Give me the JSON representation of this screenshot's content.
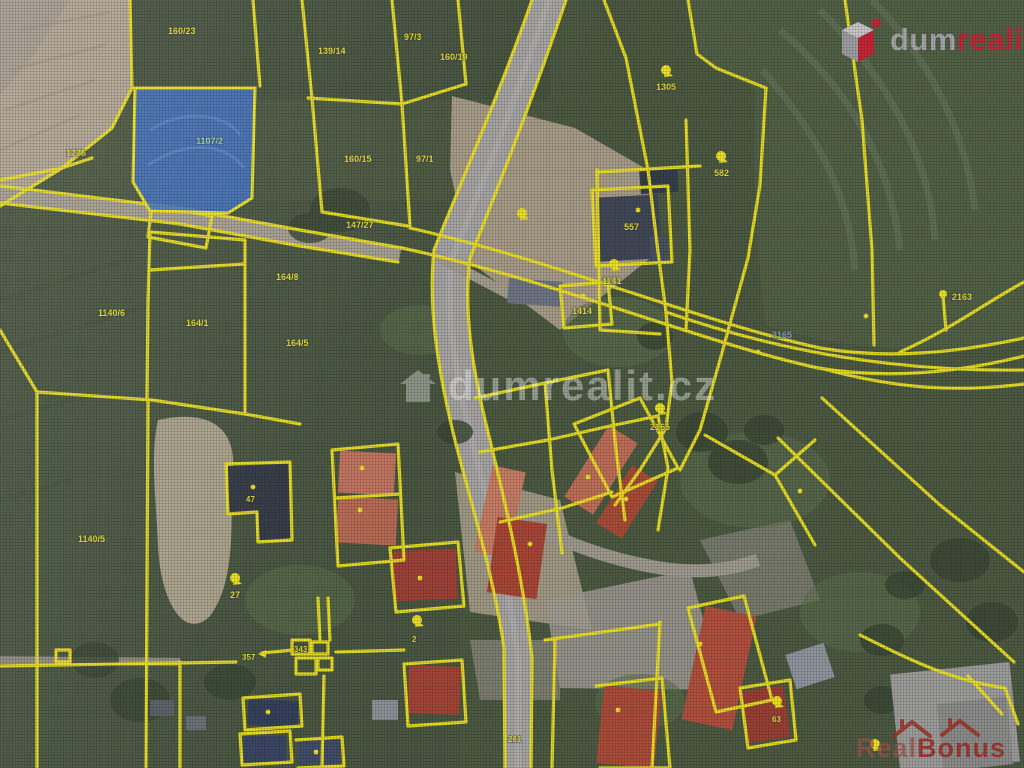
{
  "branding": {
    "logo": {
      "text_dum": "dum",
      "text_realit": "realit",
      "text_cz": ".cz",
      "red": "#c41e2f",
      "gray": "#a7a7ab"
    },
    "center_watermark": {
      "text": "dumrealit.cz"
    },
    "corner_watermark": {
      "text_real": "Real",
      "text_bonus": "Bonus",
      "color": "#9e261c"
    }
  },
  "map": {
    "type": "cadastral-satellite-view",
    "boundary_color": "#f0e41c",
    "highlighted_parcel": {
      "label": "1107/2",
      "fill": "#3f6fc0"
    },
    "parcel_labels": [
      {
        "text": "160/23"
      },
      {
        "text": "139/14"
      },
      {
        "text": "97/3"
      },
      {
        "text": "160/19"
      },
      {
        "text": "1107/2"
      },
      {
        "text": "160/15"
      },
      {
        "text": "97/1"
      },
      {
        "text": "1305"
      },
      {
        "text": "582"
      },
      {
        "text": "1276"
      },
      {
        "text": "147/27"
      },
      {
        "text": "1141"
      },
      {
        "text": "1414"
      },
      {
        "text": "557"
      },
      {
        "text": "2165"
      },
      {
        "text": "2163"
      },
      {
        "text": "1140/6"
      },
      {
        "text": "164/1"
      },
      {
        "text": "164/8"
      },
      {
        "text": "164/5"
      },
      {
        "text": "1140/5"
      },
      {
        "text": "27"
      },
      {
        "text": "357"
      },
      {
        "text": "343"
      },
      {
        "text": "63"
      },
      {
        "text": "261"
      },
      {
        "text": "2165"
      },
      {
        "text": "47"
      },
      {
        "text": "2"
      }
    ]
  }
}
